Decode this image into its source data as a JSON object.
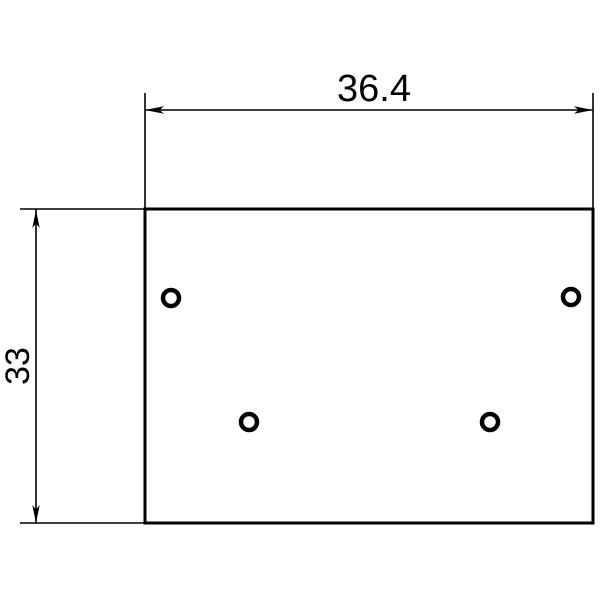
{
  "drawing": {
    "background_color": "#ffffff",
    "line_color": "#000000",
    "plate": {
      "x": 145,
      "y": 209,
      "width": 448,
      "height": 314
    },
    "hole_radius": 8,
    "holes": [
      {
        "cx": 171,
        "cy": 298
      },
      {
        "cx": 571,
        "cy": 297
      },
      {
        "cx": 249,
        "cy": 422
      },
      {
        "cx": 490,
        "cy": 422
      }
    ],
    "dim_width": {
      "label": "36.4",
      "line": {
        "x1": 145,
        "y1": 110,
        "x2": 593,
        "y2": 110
      },
      "ext_left": {
        "x1": 145,
        "y1": 93,
        "x2": 145,
        "y2": 209
      },
      "ext_right": {
        "x1": 593,
        "y1": 93,
        "x2": 593,
        "y2": 209
      },
      "arrow_left_points": "145,110 164,106.3 159.5,110 164,113.7",
      "arrow_right_points": "593,110 574,106.3 578.5,110 574,113.7",
      "text": {
        "x": 374,
        "y": 101
      }
    },
    "dim_height": {
      "label": "33",
      "line": {
        "x1": 36,
        "y1": 209,
        "x2": 36,
        "y2": 523
      },
      "ext_top": {
        "x1": 20,
        "y1": 209,
        "x2": 145,
        "y2": 209
      },
      "ext_bottom": {
        "x1": 20,
        "y1": 523,
        "x2": 145,
        "y2": 523
      },
      "arrow_top_points": "36,210 32.3,228 36,223.5 39.7,228",
      "arrow_bottom_points": "36,523 32.3,505 36,509.5 39.7,505",
      "text": {
        "x": 29,
        "y": 366,
        "rotation": "rotate(-90 29 366)"
      }
    }
  }
}
